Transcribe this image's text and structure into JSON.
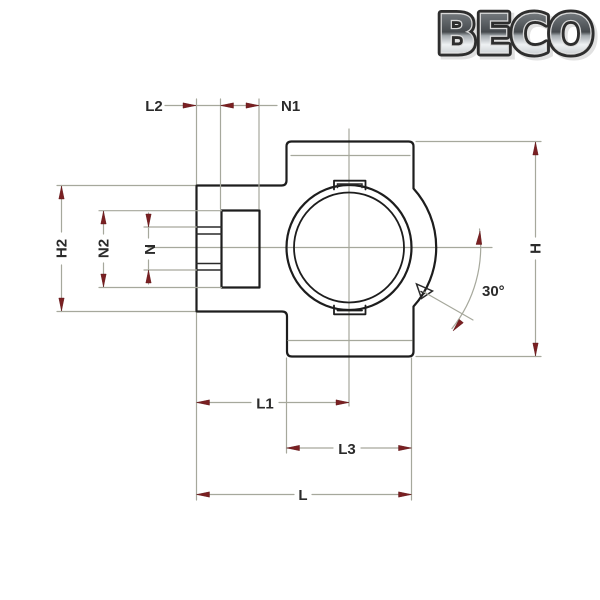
{
  "logo": {
    "text": "BECO"
  },
  "labels": {
    "l2": "L2",
    "n1": "N1",
    "h2": "H2",
    "n2": "N2",
    "n": "N",
    "h": "H",
    "angle": "30°",
    "l1": "L1",
    "l3": "L3",
    "l": "L"
  },
  "colors": {
    "outline": "#1d1d1d",
    "dimension_line": "#a6a89c",
    "arrow": "#7a2022",
    "label_text": "#2b2b2b",
    "background": "#ffffff"
  }
}
